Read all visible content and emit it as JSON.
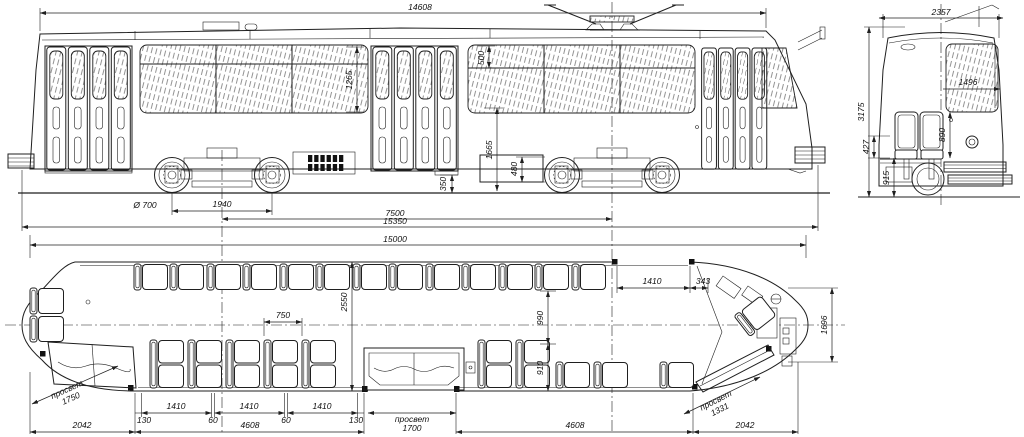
{
  "page": {
    "background": "#ffffff",
    "ink": "#1f1f1f"
  },
  "views": {
    "side": {
      "label": "side elevation",
      "dims": {
        "body_length": "14608",
        "window_height": "1265",
        "vent_height": "500",
        "sill_to_rail": "1665",
        "skirt_box_height": "480",
        "step_height": "350",
        "wheel_diameter": "Ø 700",
        "bogie_wheelbase": "1940",
        "bogie_centers": "7500",
        "overall_length": "15350",
        "frame_length": "15000"
      }
    },
    "end": {
      "label": "end view",
      "dims": {
        "body_width": "2357",
        "body_height": "3175",
        "windshield_width": "1496",
        "seat_back_height": "890",
        "seat_height": "427",
        "floor_height": "915"
      }
    },
    "plan": {
      "label": "plan view",
      "dims": {
        "interior_width": "2550",
        "seat_pitch": "750",
        "aisle_front": "990",
        "aisle_rear": "910",
        "offside_door_width": "1410",
        "offside_door_to_corner": "343",
        "rear_end_width": "1696",
        "clearance_word": "просвет",
        "front_door_clearance": "1750",
        "middle_door_clearance": "1700",
        "rear_door_clearance": "1331",
        "front_overhang": "2042",
        "rear_overhang": "2042",
        "front_bay_total": "4608",
        "rear_bay_total": "4608",
        "bay_margin_left": "130",
        "bay_margin_right": "130",
        "bay_gap_1": "60",
        "bay_gap_2": "60",
        "bay_window_1": "1410",
        "bay_window_2": "1410",
        "bay_window_3": "1410"
      }
    }
  }
}
